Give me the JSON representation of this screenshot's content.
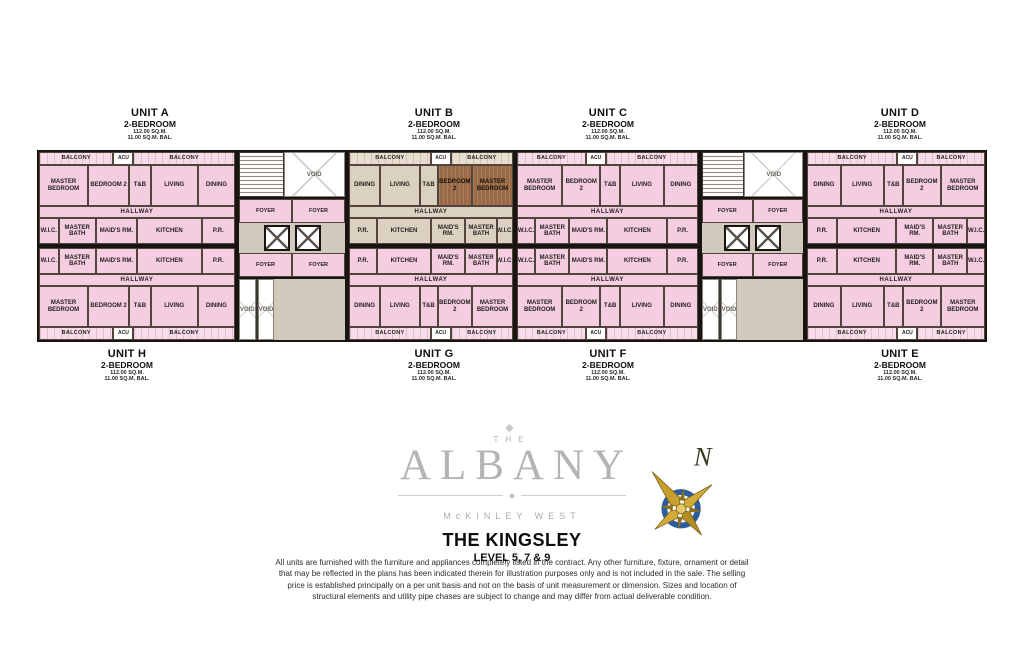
{
  "branding": {
    "ornament": "◆",
    "logo_the": "THE",
    "logo_name": "ALBANY",
    "logo_sub": "McKINLEY WEST",
    "plan_title": "THE KINGSLEY",
    "plan_subtitle": "LEVEL 5, 7 & 9"
  },
  "compass": {
    "north_label": "N"
  },
  "disclaimer": "All units are furnished with the furniture and appliances completely listed in the contract. Any other furniture, fixture, ornament or detail that may be reflected in the plans has been indicated therein for illustration purposes only and is not included in the sale. The selling price is established principally on a per unit basis and not on the basis of unit measurement or dimension. Sizes and location of structural elements and utility pipe chases are subject to change and may differ from actual deliverable condition.",
  "unit_labels": [
    {
      "name": "UNIT A",
      "type": "2-BEDROOM",
      "area": "112.00 SQ.M.",
      "balcony": "11.00 SQ.M. BAL."
    },
    {
      "name": "UNIT B",
      "type": "2-BEDROOM",
      "area": "112.00 SQ.M.",
      "balcony": "11.00 SQ.M. BAL."
    },
    {
      "name": "UNIT C",
      "type": "2-BEDROOM",
      "area": "112.00 SQ.M.",
      "balcony": "11.00 SQ.M. BAL."
    },
    {
      "name": "UNIT D",
      "type": "2-BEDROOM",
      "area": "112.00 SQ.M.",
      "balcony": "11.00 SQ.M. BAL."
    },
    {
      "name": "UNIT H",
      "type": "2-BEDROOM",
      "area": "112.00 SQ.M.",
      "balcony": "11.00 SQ.M. BAL."
    },
    {
      "name": "UNIT G",
      "type": "2-BEDROOM",
      "area": "112.00 SQ.M.",
      "balcony": "11.00 SQ.M. BAL."
    },
    {
      "name": "UNIT F",
      "type": "2-BEDROOM",
      "area": "112.00 SQ.M.",
      "balcony": "11.00 SQ.M. BAL."
    },
    {
      "name": "UNIT E",
      "type": "2-BEDROOM",
      "area": "112.00 SQ.M.",
      "balcony": "11.00 SQ.M. BAL."
    }
  ],
  "colors": {
    "unit_pink": "#f4cde0",
    "highlight_tan": "#dbd1c0",
    "highlight_brown": "#996a45",
    "core_gray": "#d0c9bc",
    "wall_black": "#181412",
    "compass_gold": "#c89f2c",
    "compass_blue": "#2d5d9f"
  },
  "plan": {
    "labels": {
      "balcony": "BALCONY",
      "acu": "ACU",
      "hallway": "HALLWAY",
      "void": "VOID",
      "foyer": "FOYER"
    },
    "main_rooms": [
      "MASTER BEDROOM",
      "BEDROOM 2",
      "T&B",
      "LIVING",
      "DINING"
    ],
    "service_rooms": [
      "W.I.C.",
      "MASTER BATH",
      "MAID'S RM.",
      "KITCHEN",
      "P.R."
    ],
    "units": {
      "A": {
        "mirror": false,
        "highlight": false
      },
      "B": {
        "mirror": true,
        "highlight": true
      },
      "C": {
        "mirror": false,
        "highlight": false
      },
      "D": {
        "mirror": true,
        "highlight": false
      },
      "H": {
        "mirror": false,
        "highlight": false
      },
      "G": {
        "mirror": true,
        "highlight": false
      },
      "F": {
        "mirror": false,
        "highlight": false
      },
      "E": {
        "mirror": true,
        "highlight": false
      }
    },
    "columns": [
      {
        "type": "units",
        "top": "A",
        "bottom": "H",
        "width": 200
      },
      {
        "type": "core",
        "width": 110
      },
      {
        "type": "units",
        "top": "B",
        "bottom": "G",
        "width": 168
      },
      {
        "type": "units",
        "top": "C",
        "bottom": "F",
        "width": 185
      },
      {
        "type": "core",
        "width": 105
      },
      {
        "type": "units",
        "top": "D",
        "bottom": "E",
        "width": 182
      }
    ]
  }
}
